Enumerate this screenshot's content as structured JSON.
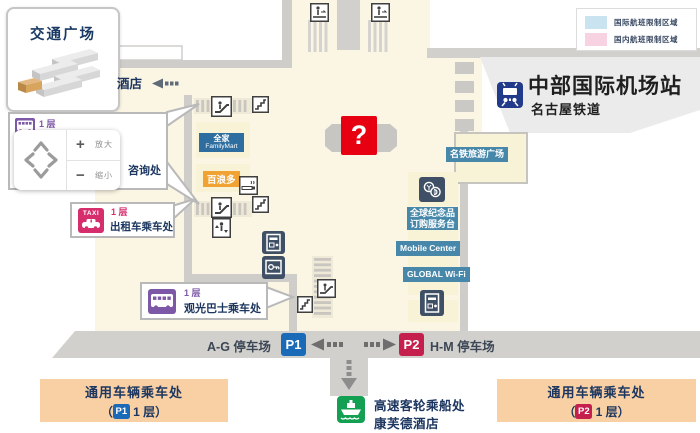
{
  "card": {
    "title": "交通广场"
  },
  "hotel": {
    "label": "酒店"
  },
  "legend": {
    "items": [
      {
        "label": "国际航班限制区域",
        "color": "#c9e3f1"
      },
      {
        "label": "国内航班限制区域",
        "color": "#f7d3e1"
      }
    ]
  },
  "station": {
    "title": "中部国际机场站",
    "subtitle": "名古屋铁道"
  },
  "nav": {
    "plus": "+",
    "zoom_in": "放大",
    "minus": "−",
    "zoom_out": "缩小"
  },
  "callouts": {
    "bus": {
      "floor": "1 层",
      "info": "咨询处"
    },
    "taxi": {
      "tag": "TAXI",
      "floor": "1 层",
      "label": "出租车乘车处"
    },
    "sightseeing": {
      "floor": "1 层",
      "label": "观光巴士乘车处"
    }
  },
  "stores": {
    "familymart_cn": "全家",
    "familymart_en": "FamilyMart",
    "pronto": "百浪多"
  },
  "services": {
    "plaza": "名铁旅游广场",
    "souvenir1": "全球纪念品",
    "souvenir2": "订购服务台",
    "mobile": "Mobile Center",
    "wifi": "GLOBAL Wi-Fi"
  },
  "help": {
    "mark": "?"
  },
  "parking": {
    "left_label": "A-G 停车场",
    "left_badge": "P1",
    "right_badge": "P2",
    "right_label": "H-M 停车场"
  },
  "pickup": {
    "left": {
      "title": "通用车辆乘车处",
      "pre": "（",
      "badge": "P1",
      "post": " 1 层）"
    },
    "right": {
      "title": "通用车辆乘车处",
      "pre": "（",
      "badge": "P2",
      "post": " 1 层）"
    }
  },
  "ferry": {
    "line1": "高速客轮乘船处",
    "line2": "康芙德酒店"
  },
  "colors": {
    "cream": "#fbf5e4",
    "road": "#d2d0cc",
    "station_bg": "#ebebeb",
    "label_blue": "#4687aa",
    "familymart_blue": "#2e6d9f",
    "pronto_orange": "#f0a232",
    "purple": "#7c58a6",
    "taxi_pink": "#d62e6c",
    "p1_blue": "#1a6ab8",
    "p2_red": "#c51f4e",
    "pickup_orange": "#f8d0a4",
    "ferry_green": "#13a053",
    "help_red": "#e60012",
    "train_blue": "#223a8a",
    "dark_icon": "#3f5066",
    "navy_text": "#1c3660"
  },
  "icons": {
    "train": "train-front",
    "taxi": "taxi-car",
    "bus": "bus-side",
    "ship": "ferry-ship",
    "escalator": "escalator",
    "stairs": "stairs",
    "elevator": "elevator",
    "moving_walkway": "moving-walkway",
    "smoking": "smoking-area",
    "atm": "atm-machine",
    "coin_locker": "coin-locker",
    "currency_exchange": "currency-exchange",
    "help": "question-mark",
    "pan": "arrow-pad"
  }
}
